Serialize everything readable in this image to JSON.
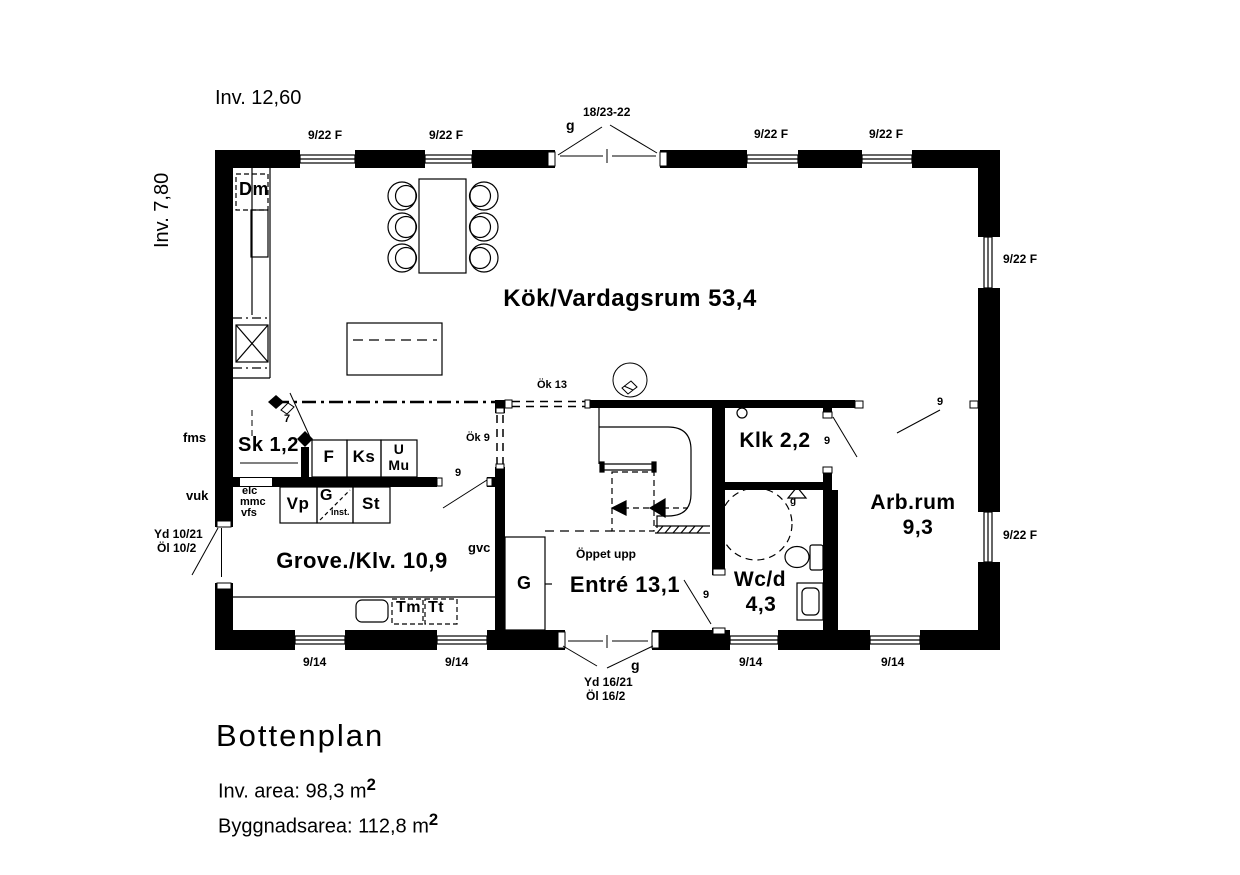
{
  "colors": {
    "ink": "#000000",
    "paper": "#ffffff"
  },
  "header": {
    "inv_width": "Inv. 12,60",
    "inv_depth": "Inv. 7,80"
  },
  "rooms": {
    "kitchen_living": "Kök/Vardagsrum 53,4",
    "grove": "Grove./Klv. 10,9",
    "entre": "Entré 13,1",
    "wc_name": "Wc/d",
    "wc_area": "4,3",
    "klk": "Klk 2,2",
    "arbrum_name": "Arb.rum",
    "arbrum_area": "9,3",
    "closet_sk": "Sk 1,2"
  },
  "annotations": {
    "window_f": "9/22 F",
    "window_small": "9/14",
    "top_door_size": "18/23-22",
    "g": "g",
    "nine": "9",
    "seven": "7",
    "ok13": "Ök 13",
    "ok9": "Ök 9",
    "front_door": "Yd 16/21",
    "front_door_light": "Öl 16/2",
    "side_door": "Yd 10/21",
    "side_door_light": "Öl 10/2",
    "open_above": "Öppet upp",
    "gvc": "gvc",
    "fms": "fms",
    "vuk": "vuk",
    "floor_drain": "g"
  },
  "appliances": {
    "dm": "Dm",
    "f": "F",
    "ks": "Ks",
    "u": "U",
    "mu": "Mu",
    "vp": "Vp",
    "g_inst": "G",
    "inst": "inst.",
    "st": "St",
    "tm": "Tm",
    "tt": "Tt",
    "wardrobe": "G",
    "elc": "elc",
    "mmc": "mmc",
    "vfs": "vfs"
  },
  "footer": {
    "title": "Bottenplan",
    "inv_area": "Inv. area: 98,3 m",
    "building_area": "Byggnadsarea: 112,8 m",
    "sup": "2"
  }
}
